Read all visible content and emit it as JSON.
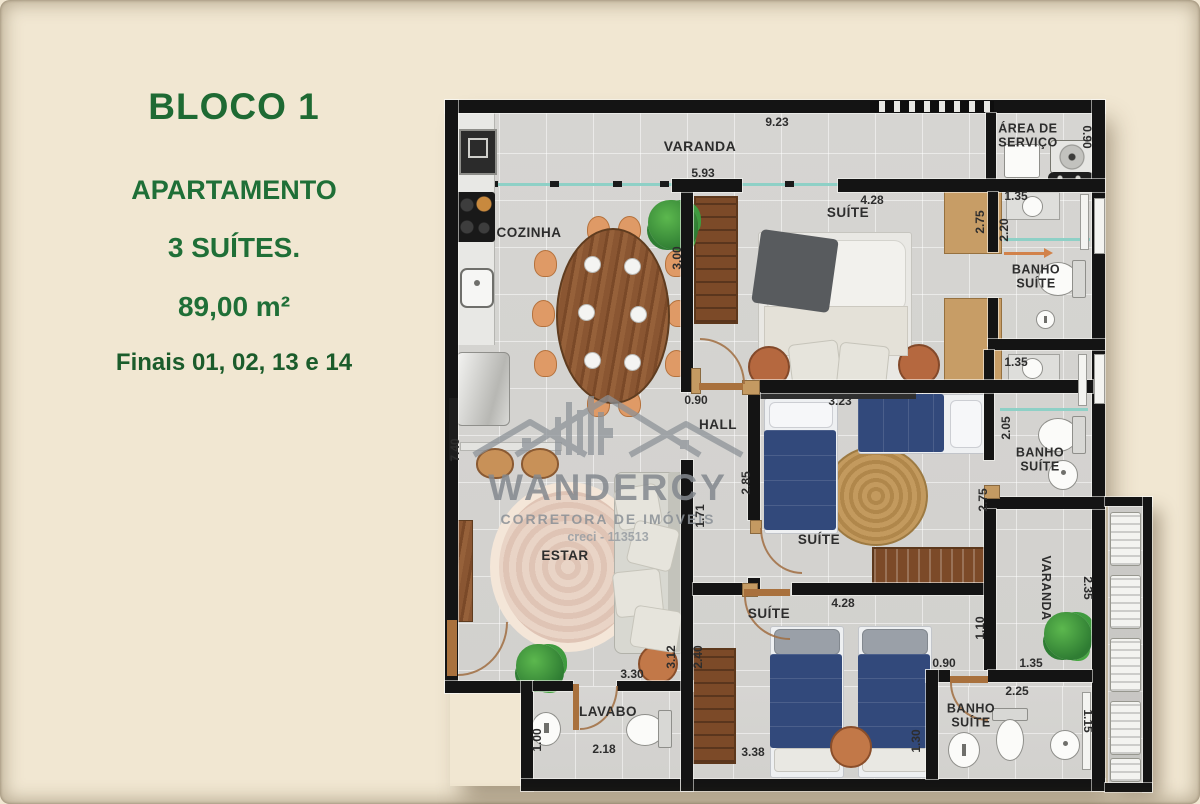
{
  "panel": {
    "bloco": "BLOCO 1",
    "tipo": "APARTAMENTO",
    "suites": "3 SUÍTES.",
    "area": "89,00 m²",
    "finais": "Finais 01, 02, 13 e 14"
  },
  "watermark": {
    "brand": "WANDERCY",
    "subtitle": "CORRETORA DE IMÓVEIS",
    "creci": "creci - 113513"
  },
  "rooms": {
    "varanda": "VARANDA",
    "cozinha": "COZINHA",
    "suite_a": "SUÍTE",
    "suite_b": "SUÍTE",
    "suite_c": "SUÍTE",
    "servico": "ÁREA DE\nSERVIÇO",
    "banho_a": "BANHO\nSUÍTE",
    "banho_b": "BANHO\nSUÍTE",
    "banho_c": "BANHO\nSUÍTE",
    "hall": "HALL",
    "estar": "ESTAR",
    "lavabo": "LAVABO",
    "varanda2": "VARANDA"
  },
  "dims": {
    "w923": "9.23",
    "w593": "5.93",
    "suite1_w": "4.28",
    "suite1_d": "3.00",
    "servico_d": "0.90",
    "banho1_w": "1.35",
    "closet1_d": "2.75",
    "banho1_d": "2.20",
    "banho2_w": "1.35",
    "banho2_d": "2.05",
    "closet2_d": "2.75",
    "hall_door": "0.90",
    "suite2_w": "3.23",
    "suite2_d": "2.85",
    "hall_d": "1.71",
    "total_d": "7.40",
    "var2_d": "2.35",
    "var2_gap": "1.10",
    "banho3_door": "0.90",
    "var2_w": "1.35",
    "banho3_w": "2.25",
    "banho3_d": "1.15",
    "bed_gap": "1.30",
    "suite3_w": "4.28",
    "suite3_bed": "3.38",
    "estar_w": "3.30",
    "estar_d": "3.12",
    "hall2_d": "2.40",
    "lavabo_w": "2.18",
    "lavabo_d": "1.00"
  },
  "colors": {
    "accent_green": "#1e6a33",
    "wall": "#141414",
    "floor": "#d6d5d2",
    "wood": "#8a5632",
    "bed_blue": "#32497b",
    "glass_teal": "#8ed0c6",
    "background": "#f1e7d2"
  }
}
